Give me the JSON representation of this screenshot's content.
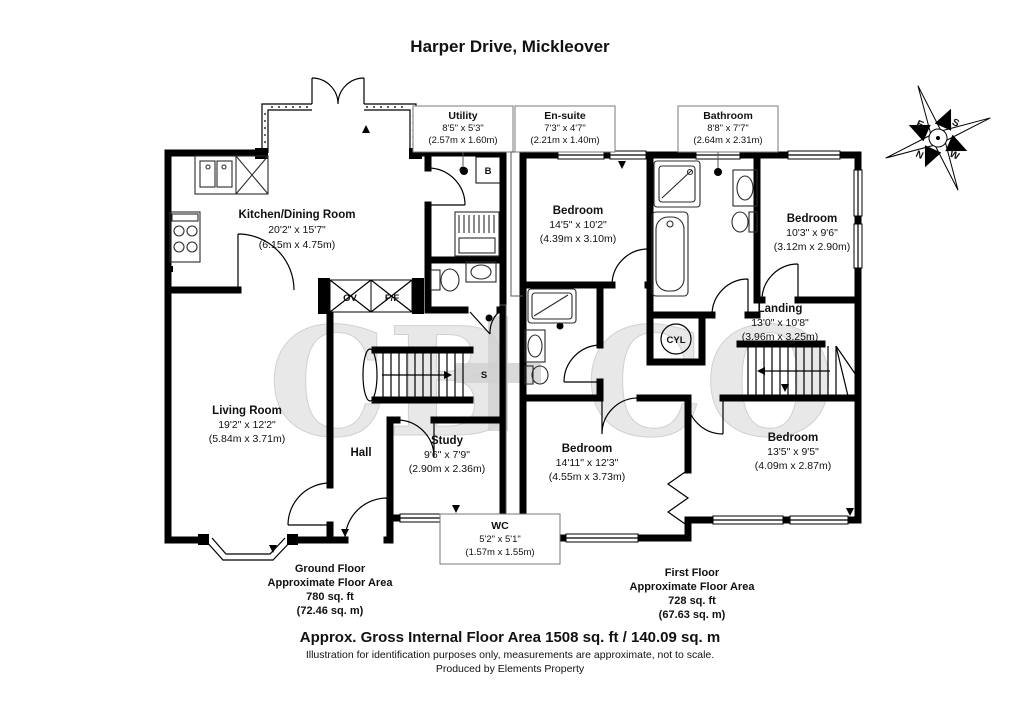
{
  "title": "Harper Drive, Mickleover",
  "watermark": {
    "left": "CB",
    "right": "CO"
  },
  "compass": {
    "north": "N",
    "south": "S",
    "east": "E",
    "west": "W"
  },
  "ground_floor": {
    "summary": {
      "floor": "Ground Floor",
      "area_label": "Approximate Floor Area",
      "area_sqft": "780 sq. ft",
      "area_sqm": "(72.46 sq. m)"
    },
    "kitchen": {
      "name": "Kitchen/Dining Room",
      "imperial": "20'2\" x 15'7\"",
      "metric": "(6.15m x 4.75m)"
    },
    "living": {
      "name": "Living Room",
      "imperial": "19'2\" x 12'2\"",
      "metric": "(5.84m x 3.71m)"
    },
    "hall": {
      "name": "Hall"
    },
    "study": {
      "name": "Study",
      "imperial": "9'6\" x 7'9\"",
      "metric": "(2.90m x 2.36m)"
    },
    "utility": {
      "name": "Utility",
      "imperial": "8'5\" x 5'3\"",
      "metric": "(2.57m x 1.60m)"
    },
    "wc": {
      "name": "WC",
      "imperial": "5'2\" x 5'1\"",
      "metric": "(1.57m x 1.55m)"
    },
    "labels": {
      "oven": "OV",
      "fridge_freezer": "F/F",
      "boiler": "B",
      "store": "S"
    }
  },
  "first_floor": {
    "summary": {
      "floor": "First Floor",
      "area_label": "Approximate Floor Area",
      "area_sqft": "728 sq. ft",
      "area_sqm": "(67.63 sq. m)"
    },
    "bedroom1": {
      "name": "Bedroom",
      "imperial": "14'5\" x 10'2\"",
      "metric": "(4.39m x 3.10m)"
    },
    "bedroom2": {
      "name": "Bedroom",
      "imperial": "10'3\" x 9'6\"",
      "metric": "(3.12m x 2.90m)"
    },
    "bedroom3": {
      "name": "Bedroom",
      "imperial": "14'11\" x 12'3\"",
      "metric": "(4.55m x 3.73m)"
    },
    "bedroom4": {
      "name": "Bedroom",
      "imperial": "13'5\" x 9'5\"",
      "metric": "(4.09m x 2.87m)"
    },
    "landing": {
      "name": "Landing",
      "imperial": "13'0\" x 10'8\"",
      "metric": "(3.96m x 3.25m)"
    },
    "ensuite": {
      "name": "En-suite",
      "imperial": "7'3\" x 4'7\"",
      "metric": "(2.21m x 1.40m)"
    },
    "bathroom": {
      "name": "Bathroom",
      "imperial": "8'8\" x 7'7\"",
      "metric": "(2.64m x 2.31m)"
    },
    "labels": {
      "cylinder": "CYL"
    }
  },
  "footer": {
    "total_area": "Approx. Gross Internal Floor Area 1508 sq. ft / 140.09 sq. m",
    "disclaimer": "Illustration for identification purposes only, measurements are approximate, not to scale.",
    "produced_by": "Produced by Elements Property"
  }
}
